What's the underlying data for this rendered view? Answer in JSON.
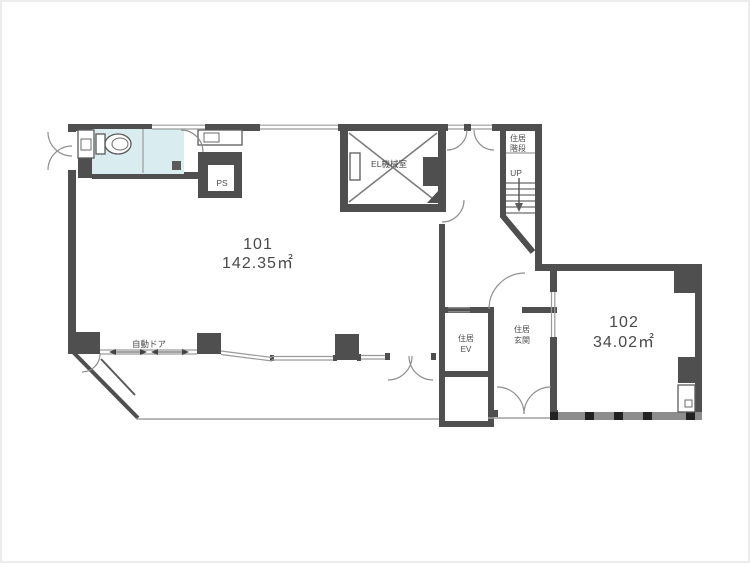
{
  "plan": {
    "rooms": {
      "r101": {
        "number": "101",
        "area": "142.35㎡"
      },
      "r102": {
        "number": "102",
        "area": "34.02㎡"
      }
    },
    "labels": {
      "el_machine_room": "EL機械室",
      "pipe_shaft": "PS",
      "stairs_line1": "住居",
      "stairs_line2": "階段",
      "up": "UP",
      "elevator_line1": "住居",
      "elevator_line2": "EV",
      "entrance_line1": "住居",
      "entrance_line2": "玄関",
      "automatic_door": "自動ドア"
    },
    "fixtures": {
      "toilet": "toilet-icon",
      "washbasin": "washbasin-icon",
      "sink_counter": "sink-counter-icon",
      "water_heater": "water-heater-icon"
    },
    "colors": {
      "wall": "#4f4f4f",
      "line": "#8f8f8f",
      "toilet_floor": "#d9edf1",
      "window_band": "#8d8d8d",
      "text": "#4a4a4a",
      "background": "#ffffff"
    }
  }
}
